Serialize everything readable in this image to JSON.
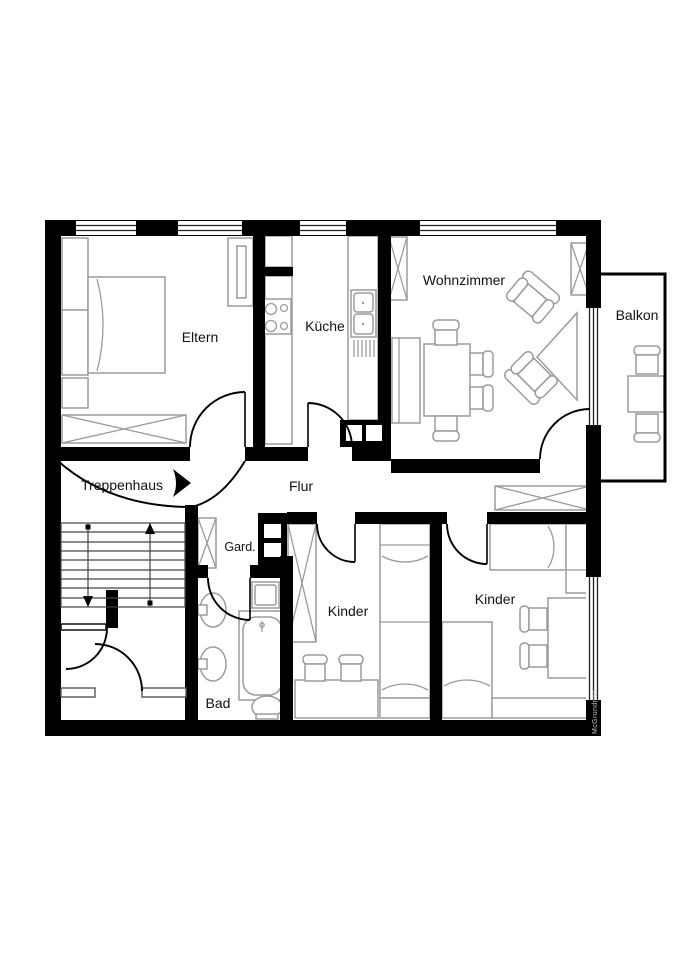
{
  "floorplan": {
    "watermark": "McGrundriss",
    "colors": {
      "wall": "#000000",
      "furniture_outline": "#9b9b9b",
      "label_text": "#111111",
      "background": "#ffffff"
    },
    "rooms": {
      "eltern": {
        "label": "Eltern"
      },
      "kueche": {
        "label": "Küche"
      },
      "wohnzimmer": {
        "label": "Wohnzimmer"
      },
      "balkon": {
        "label": "Balkon"
      },
      "treppenhaus": {
        "label": "Treppenhaus"
      },
      "flur": {
        "label": "Flur"
      },
      "garderobe": {
        "label": "Gard."
      },
      "bad": {
        "label": "Bad"
      },
      "kinder_1": {
        "label": "Kinder"
      },
      "kinder_2": {
        "label": "Kinder"
      }
    },
    "icons": [
      "double-bed-icon",
      "single-bed-icon",
      "wardrobe-crossed-icon",
      "stove-icon",
      "kitchen-sink-icon",
      "dining-table-icon",
      "chair-icon",
      "armchair-icon",
      "corner-table-icon",
      "stairs-icon",
      "direction-arrow-icon",
      "washbasin-icon",
      "bathtub-icon",
      "toilet-icon",
      "washing-machine-icon",
      "desk-icon",
      "stool-icon",
      "balcony-table-icon"
    ]
  }
}
